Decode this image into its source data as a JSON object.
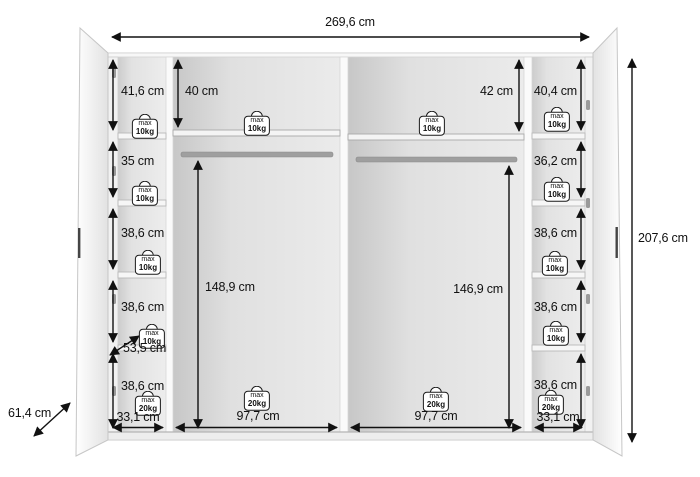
{
  "diagram": {
    "overall": {
      "width": "269,6 cm",
      "height": "207,6 cm",
      "depth": "61,4 cm"
    },
    "left_column": {
      "compartment_heights": [
        "41,6 cm",
        "35 cm",
        "38,6 cm",
        "38,6 cm",
        "38,6 cm"
      ],
      "shelf_diagonal": "53,5 cm",
      "bottom_width": "33,1 cm"
    },
    "center_left": {
      "top_compartment_height": "40 cm",
      "hanging_height": "148,9 cm",
      "bottom_width": "97,7 cm"
    },
    "center_right": {
      "top_compartment_height": "42 cm",
      "hanging_height": "146,9 cm",
      "bottom_width": "97,7 cm"
    },
    "right_column": {
      "compartment_heights": [
        "40,4 cm",
        "36,2 cm",
        "38,6 cm",
        "38,6 cm",
        "38,6 cm"
      ],
      "bottom_width": "33,1 cm"
    },
    "load_badge": {
      "prefix": "max",
      "limit_10kg": "10kg",
      "limit_20kg": "20kg"
    },
    "colors": {
      "line": "#111111",
      "interior": "#e7e7e7",
      "panel": "#fafafa"
    }
  }
}
